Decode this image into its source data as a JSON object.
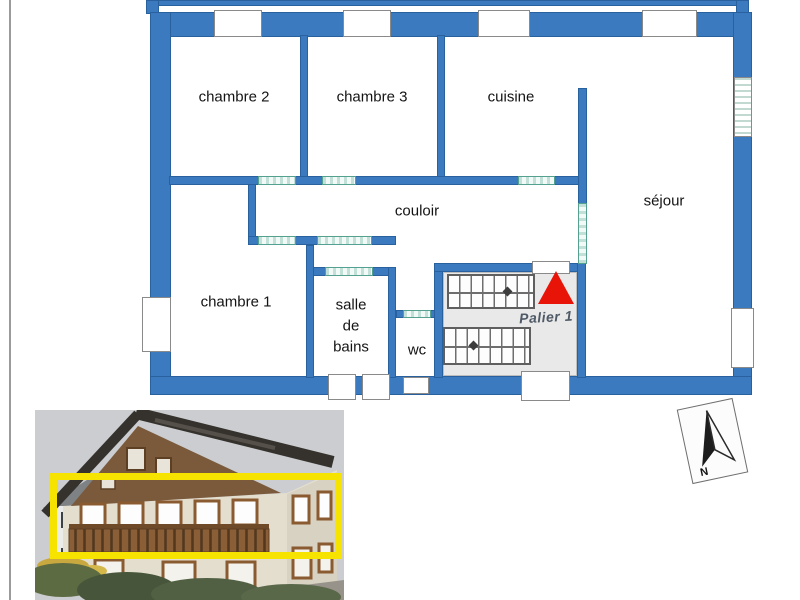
{
  "floor_plan": {
    "rooms": [
      {
        "id": "chambre-2",
        "label": "chambre 2"
      },
      {
        "id": "chambre-3",
        "label": "chambre 3"
      },
      {
        "id": "cuisine",
        "label": "cuisine"
      },
      {
        "id": "sejour",
        "label": "séjour"
      },
      {
        "id": "couloir",
        "label": "couloir"
      },
      {
        "id": "chambre-1",
        "label": "chambre 1"
      },
      {
        "id": "salle-de-bains",
        "label": "salle\nde\nbains"
      },
      {
        "id": "wc",
        "label": "wc"
      }
    ],
    "landing_label": "Palier 1",
    "colors": {
      "wall_blue": "#3c7ac0",
      "wall_border": "#29619f",
      "room_outline_teal": "#55a190",
      "landing_gray": "#e9e9e9",
      "stair_marker_red": "#e81408"
    }
  },
  "compass": {
    "north_label": "N"
  },
  "photo": {
    "highlight_color": "#f6e400"
  }
}
